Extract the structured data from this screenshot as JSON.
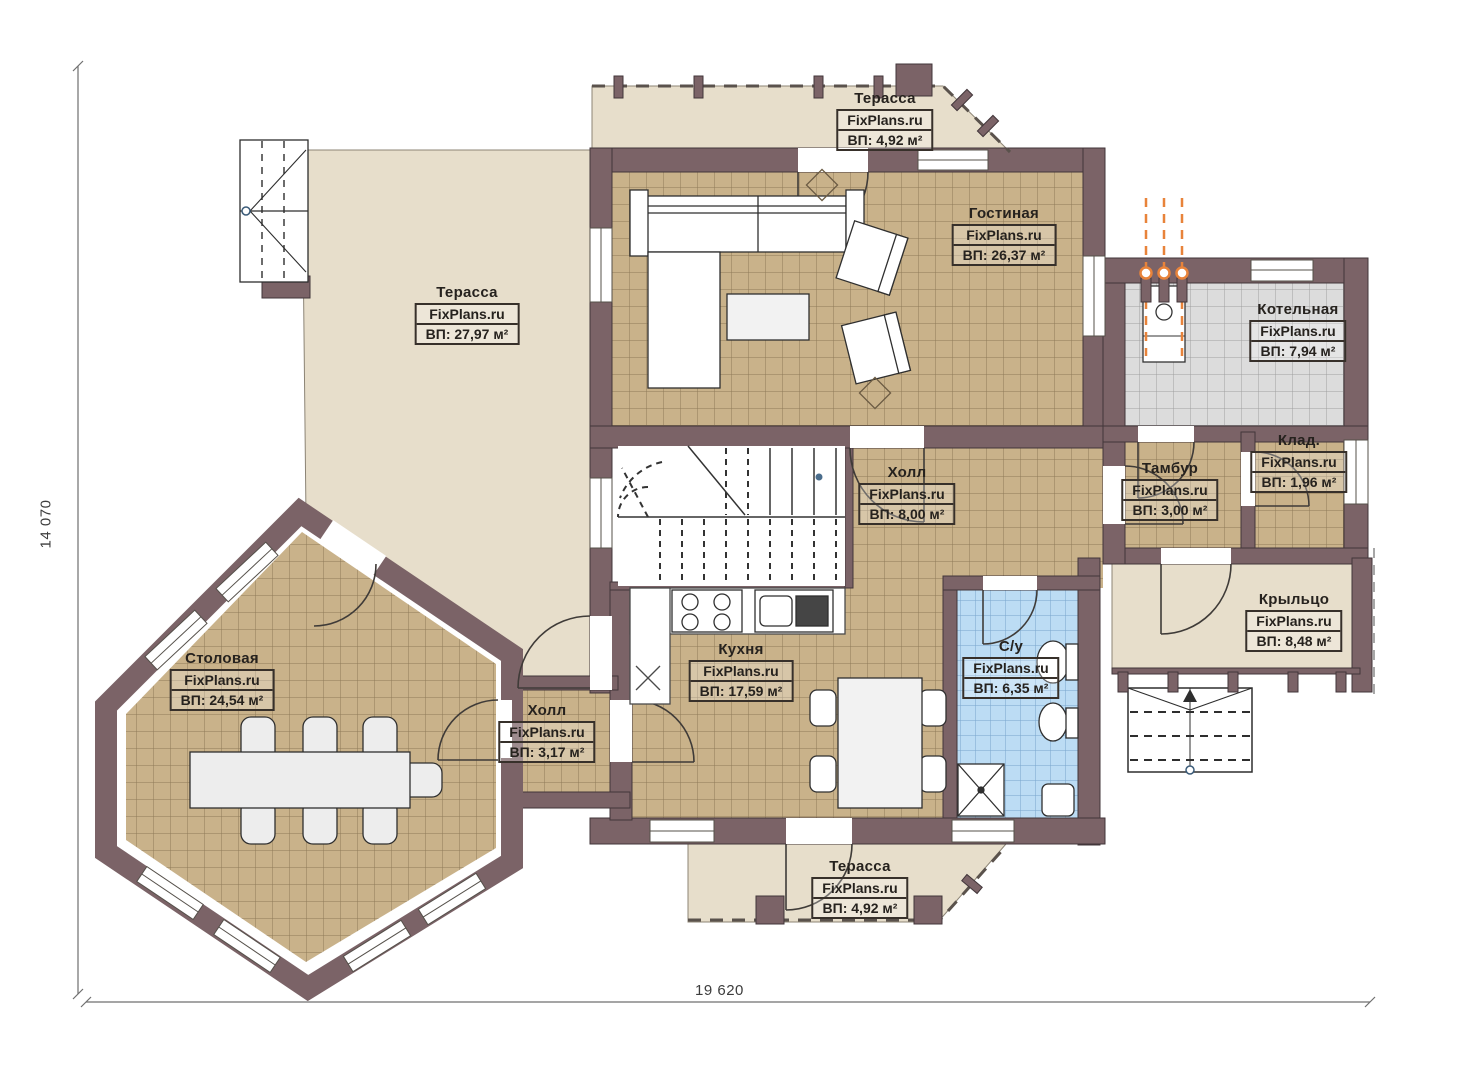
{
  "plan": {
    "watermark": "FixPlans.ru",
    "dimensions": {
      "height": "14 070",
      "width": "19 620"
    },
    "rooms": [
      {
        "name": "Терасса",
        "area": "ВП: 4,92 м²"
      },
      {
        "name": "Гостиная",
        "area": "ВП: 26,37 м²"
      },
      {
        "name": "Котельная",
        "area": "ВП: 7,94 м²"
      },
      {
        "name": "Тамбур",
        "area": "ВП: 3,00 м²"
      },
      {
        "name": "Клад.",
        "area": "ВП: 1,96 м²"
      },
      {
        "name": "Холл",
        "area": "ВП: 8,00 м²"
      },
      {
        "name": "Крыльцо",
        "area": "ВП: 8,48 м²"
      },
      {
        "name": "Терасса",
        "area": "ВП: 27,97 м²"
      },
      {
        "name": "Столовая",
        "area": "ВП: 24,54 м²"
      },
      {
        "name": "Холл",
        "area": "ВП: 3,17 м²"
      },
      {
        "name": "Кухня",
        "area": "ВП: 17,59 м²"
      },
      {
        "name": "С/у",
        "area": "ВП: 6,35 м²"
      },
      {
        "name": "Терасса",
        "area": "ВП: 4,92 м²"
      }
    ],
    "colors": {
      "wall": "#7b6367",
      "floor": "#c9b28a",
      "terrace": "#e7decb",
      "boiler": "#dcdcdc",
      "bath": "#bcdcf4",
      "pipe": "#e8833a"
    }
  }
}
